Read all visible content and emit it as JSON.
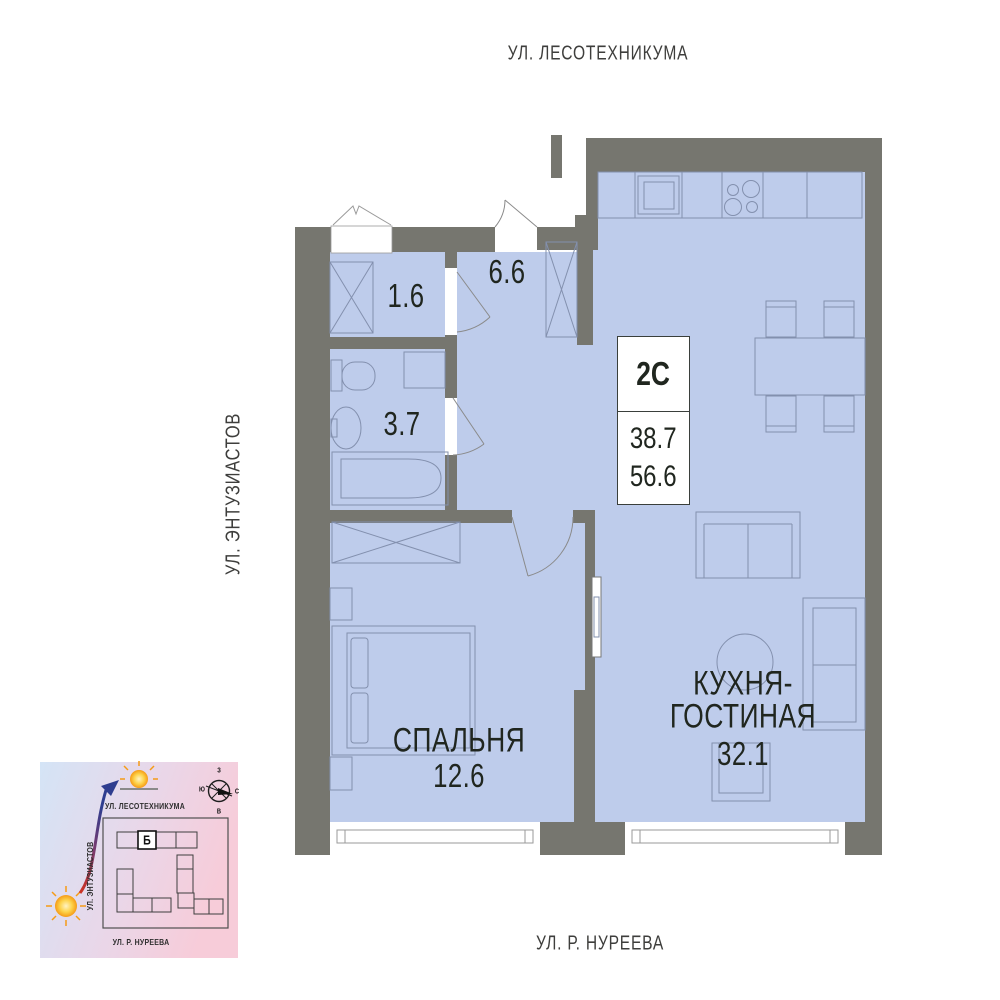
{
  "streets": {
    "top": "УЛ. ЛЕСОТЕХНИКУМА",
    "left": "УЛ. ЭНТУЗИАСТОВ",
    "bottom": "УЛ. Р. НУРЕЕВА"
  },
  "apartment": {
    "type_label": "2С",
    "living_area": "38.7",
    "total_area": "56.6",
    "rooms": {
      "closet": {
        "area": "1.6"
      },
      "hallway": {
        "area": "6.6"
      },
      "bathroom": {
        "area": "3.7"
      },
      "bedroom": {
        "name": "СПАЛЬНЯ",
        "area": "12.6"
      },
      "kitchen_living": {
        "name_line1": "КУХНЯ-",
        "name_line2": "ГОСТИНАЯ",
        "area": "32.1"
      }
    }
  },
  "minimap": {
    "streets": {
      "top": "УЛ. ЛЕСОТЕХНИКУМА",
      "left": "УЛ. ЭНТУЗИАСТОВ",
      "bottom": "УЛ. Р. НУРЕЕВА"
    },
    "building_label": "Б",
    "compass": {
      "top": "З",
      "right": "С",
      "bottom": "В",
      "left": "Ю"
    }
  },
  "colors": {
    "wall": "#76766f",
    "room_fill": "#becceb",
    "furniture_stroke": "#8390ae",
    "label_text": "#20261f",
    "street_text": "#3e3e3c",
    "sun": "#f59b16",
    "arrow_red": "#cf3322",
    "arrow_blue": "#2e3d8f",
    "map_gradient_start": "#d4e4f6",
    "map_gradient_end": "#f7ccd9"
  }
}
